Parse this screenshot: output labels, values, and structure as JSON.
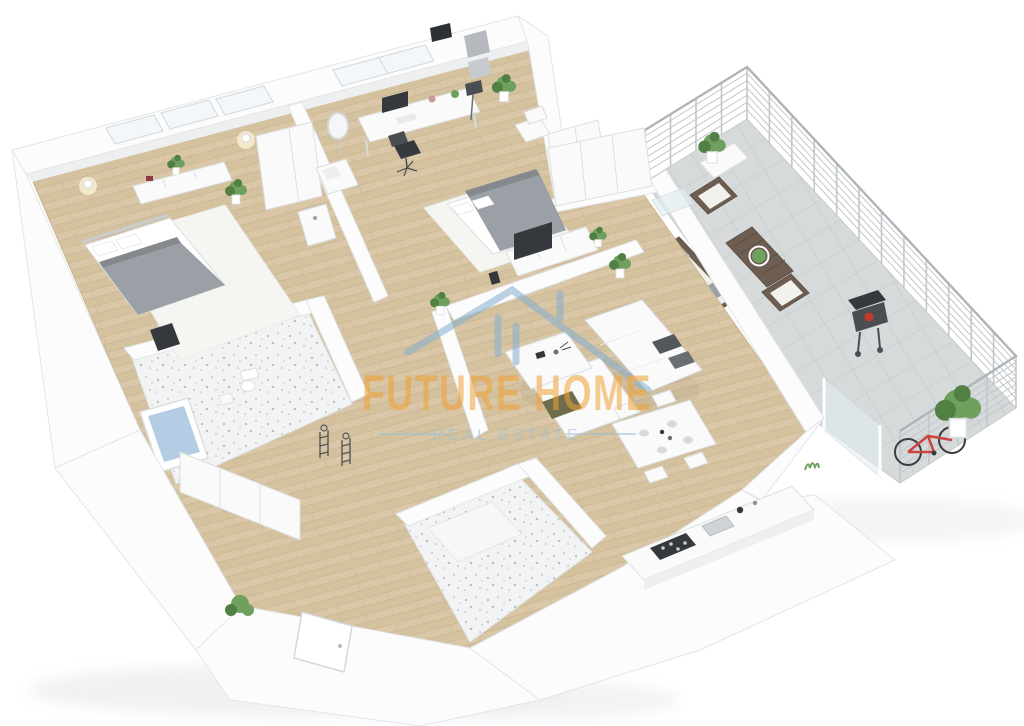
{
  "image": {
    "kind": "3d-isometric-floorplan-render",
    "description": "Top-down 3D render of a furnished apartment with bedrooms, office, living room, kitchen/dining, two bathrooms, hallway and a large tiled terrace with railing"
  },
  "watermark": {
    "title": "FUTURE HOME",
    "subtitle": "REAL ESTATE"
  },
  "colors": {
    "wall": "#fcfcfd",
    "wallStroke": "#e2e5e8",
    "wallSide": "#edeff1",
    "wood": "#d9c7a7",
    "wood2": "#cfbb97",
    "woodline": "#c3ae8b",
    "tile": "#d7dada",
    "tileline": "#c2c7c7",
    "bathtile": "#f2f3f4",
    "speck": "#b8bdc2",
    "rug": "#f5f5f2",
    "furnWhite": "#fafafa",
    "furnStroke": "#dcdfe2",
    "blanket": "#9aa0a5",
    "blanketDark": "#85898e",
    "sheet": "#ffffff",
    "pillow": "#54585d",
    "throw": "#6e6c4b",
    "darkitem": "#35383c",
    "water": "#b4cde4",
    "plant": "#6fa05e",
    "plantd": "#527f43",
    "pot": "#ffffff",
    "outdoor": "#6e5e51",
    "cushion": "#f2f1ec",
    "bike": "#cc4540",
    "fire": "#c23b2e",
    "glass": "#e3edf3",
    "railing": "#c2c7cb",
    "wmOrange": "#f0a235",
    "wmBlue": "#85afd1",
    "wmSub": "#9cc0d6",
    "shadow": "#e2e5e8"
  },
  "rooms": [
    {
      "id": "bedroom-1",
      "label": "Bedroom 1",
      "furniture": [
        "double-bed",
        "rug",
        "dresser",
        "wardrobe",
        "side-table",
        "valet-chair",
        "wall-lamps",
        "windows",
        "plants"
      ]
    },
    {
      "id": "home-office",
      "label": "Office",
      "furniture": [
        "desk",
        "monitor",
        "desk-lamp",
        "office-chair",
        "lounge-chair",
        "loveseat",
        "standing-mirror",
        "floor-lamp",
        "wall-art",
        "plants"
      ]
    },
    {
      "id": "bedroom-2",
      "label": "Bedroom 2",
      "furniture": [
        "double-bed",
        "rug",
        "tv-console",
        "tv",
        "wardrobe",
        "balcony-door",
        "plants"
      ]
    },
    {
      "id": "living-room",
      "label": "Living Room",
      "furniture": [
        "corner-sofa",
        "pillows",
        "throw",
        "coffee-table",
        "plant"
      ]
    },
    {
      "id": "kitchen-dining",
      "label": "Kitchen / Dining",
      "furniture": [
        "dining-table",
        "dining-chairs",
        "plates",
        "kitchen-counter",
        "stove",
        "sink",
        "kettle"
      ]
    },
    {
      "id": "bathroom-1",
      "label": "Bathroom 1",
      "furniture": [
        "bathtub",
        "toilet",
        "stool",
        "cabinet-row",
        "towel-stands"
      ]
    },
    {
      "id": "bathroom-2",
      "label": "Bathroom 2",
      "furniture": [
        "shower-screen"
      ]
    },
    {
      "id": "hallway",
      "label": "Hallway",
      "furniture": [
        "entrance-door",
        "bush"
      ]
    },
    {
      "id": "terrace",
      "label": "Terrace",
      "furniture": [
        "railing",
        "outdoor-armchair",
        "outdoor-armchair",
        "outdoor-sofa",
        "outdoor-table",
        "planter",
        "bbq-grill",
        "bicycle",
        "glass-screen",
        "bush",
        "plants"
      ]
    }
  ]
}
